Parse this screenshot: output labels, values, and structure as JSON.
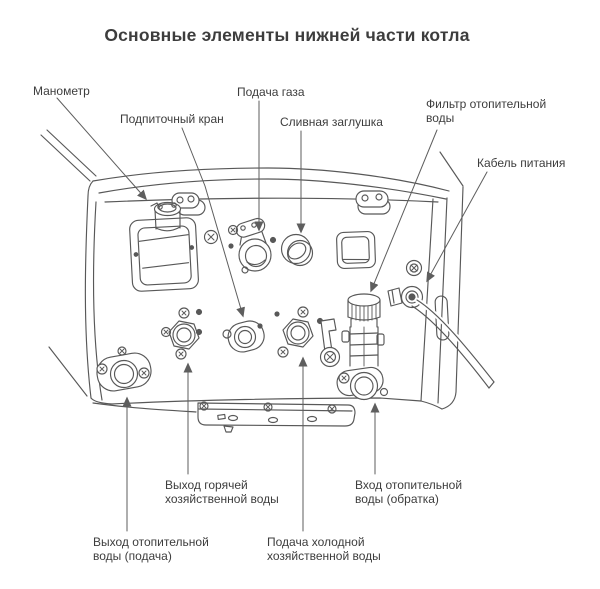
{
  "title": "Основные элементы нижней части котла",
  "colors": {
    "line": "#585858",
    "leader": "#5e5e5e",
    "text": "#3d3d3d",
    "background": "#ffffff"
  },
  "labels": {
    "manometer": "Манометр",
    "makeup_valve": "Подпиточный кран",
    "gas_supply": "Подача газа",
    "drain_plug": "Сливная заглушка",
    "heating_water_filter": [
      "Фильтр отопительной",
      "воды"
    ],
    "power_cable": "Кабель питания",
    "dhw_hot_outlet": [
      "Выход горячей",
      "хозяйственной воды"
    ],
    "heating_inlet_return": [
      "Вход отопительной",
      "воды (обратка)"
    ],
    "heating_outlet_supply": [
      "Выход отопительной",
      "воды (подача)"
    ],
    "cold_water_supply": [
      "Подача холодной",
      "хозяйственной воды"
    ]
  }
}
